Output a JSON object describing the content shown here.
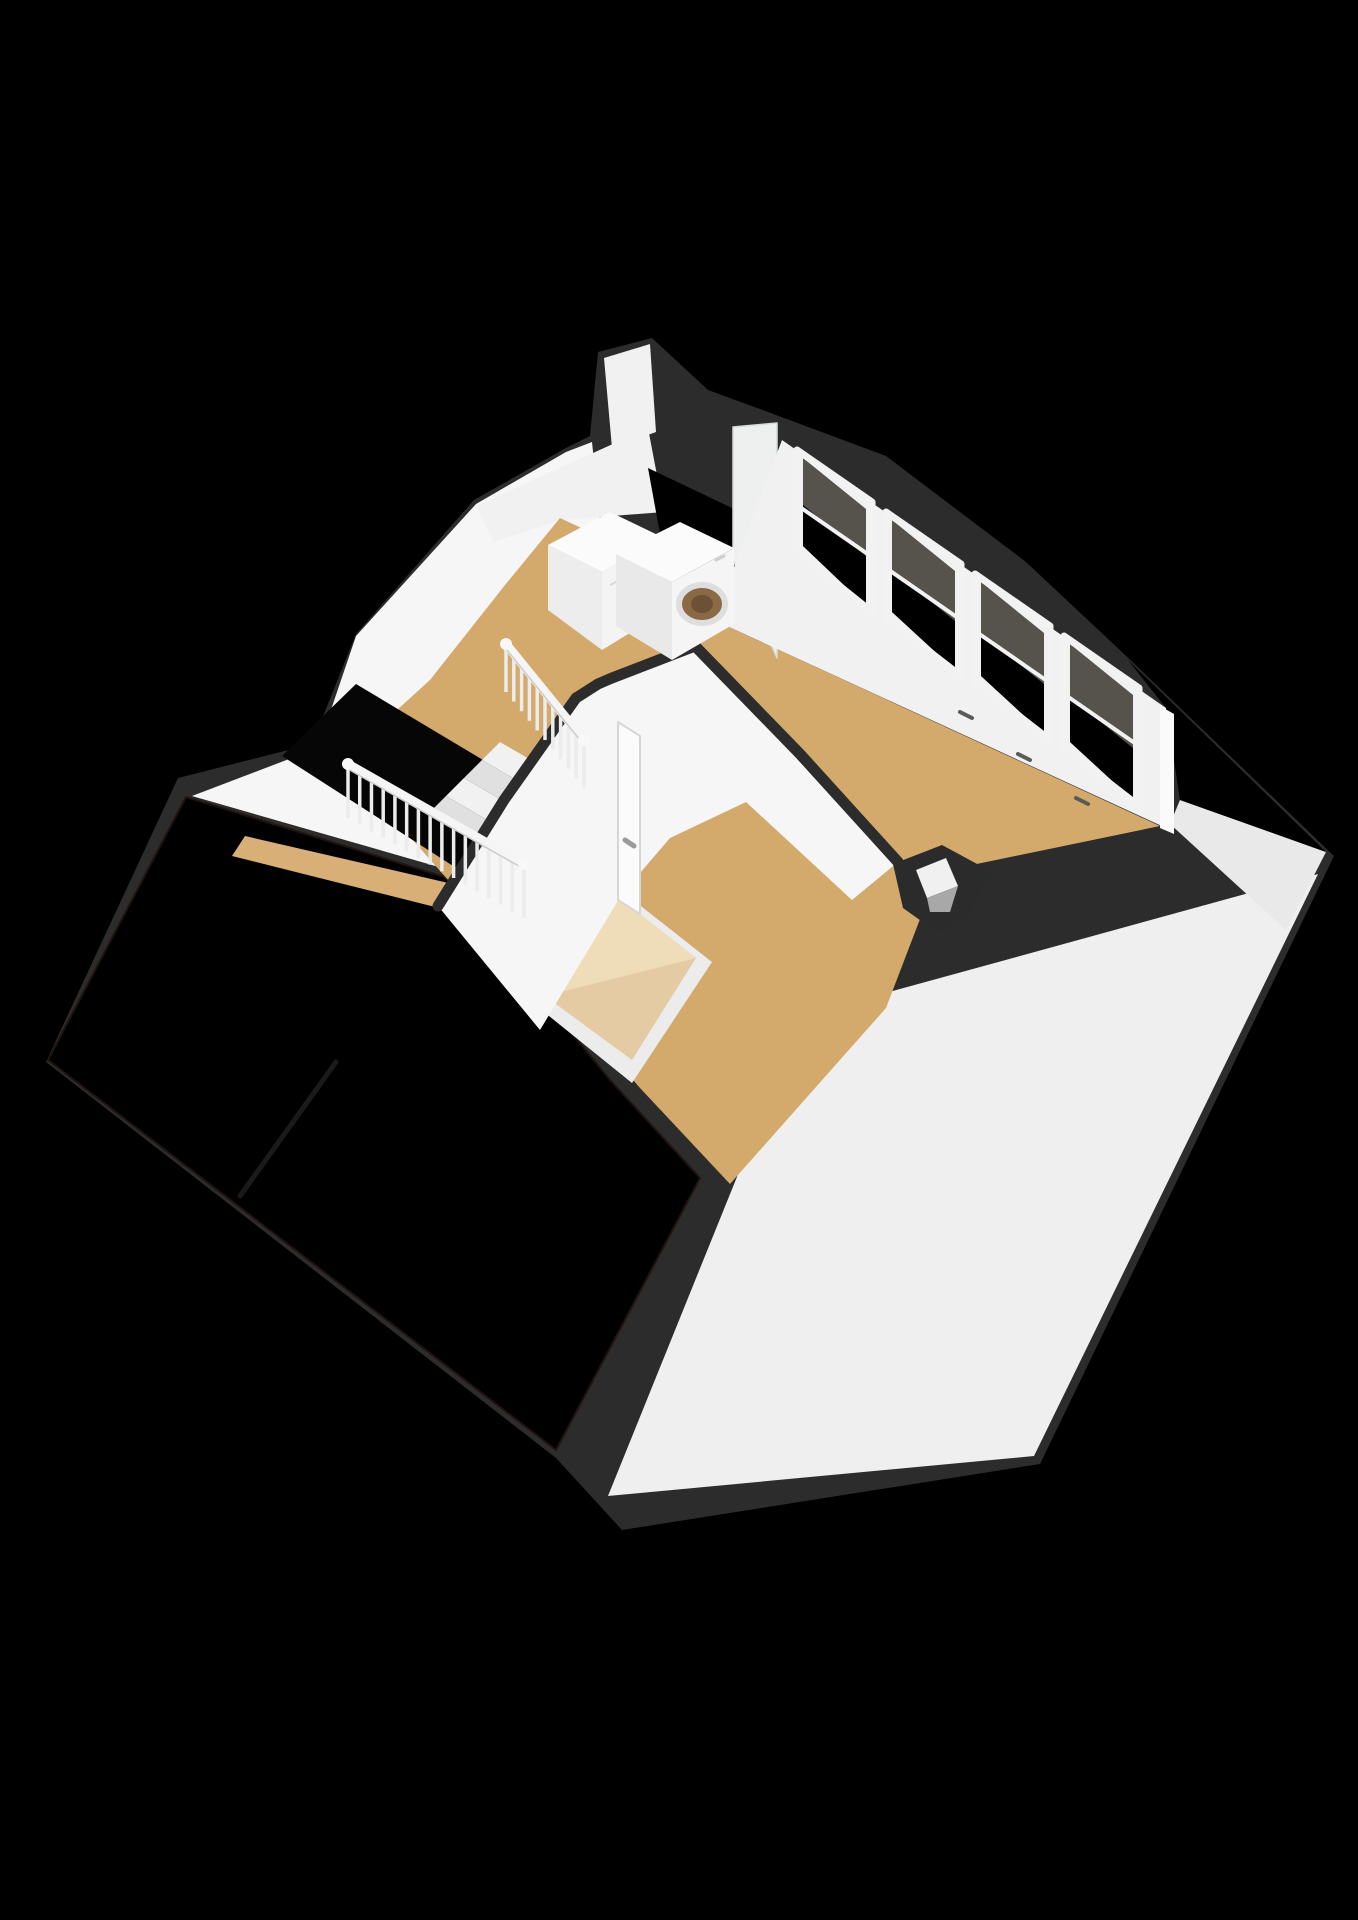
{
  "meta": {
    "kind": "3d-floorplan-render",
    "background": "#000000"
  },
  "palette": {
    "silhouette": "#2c2c2c",
    "roof_tile_base": "#6e4134",
    "roof_tile_shadow": "#59352a",
    "roof_tile_gap": "#231510",
    "pink_tile_base": "#c28266",
    "pink_tile_line": "#8e5442",
    "wall_bright": "#f6f6f6",
    "wall_plain": "#f1f1f1",
    "wall_dim": "#e9e9e9",
    "floor_tan": "#d3aa6c",
    "floor_tan_light": "#d8b077",
    "stairwell_black": "#060606",
    "step_light": "#f1f1f1",
    "step_dark": "#e0e0e0",
    "glass_dark": "#55534b",
    "frame_white": "#f2f2f2",
    "skylight_frame": "#ececec",
    "skylight_pane": "#e4cba3",
    "skylight_pane_hl": "#f0debb",
    "washer_glass": "#8a6a45",
    "washer_glass_inner": "#6e5034",
    "metal_grey": "#9a9a9a",
    "slope_white": "#efefef"
  },
  "scene": {
    "width": 1358,
    "height": 1920,
    "elements": [
      {
        "name": "house-silhouette-band",
        "kind": "polygon",
        "fill": "@silhouette",
        "points": "598,352 652,338 708,390 768,412 886,456 1026,562 1122,652 1334,856 1040,1464 622,1530 556,1458 46,1062 178,778 312,744 356,634 474,500 566,448 590,436"
      },
      {
        "name": "roof-slope-rear-white",
        "kind": "polygon",
        "fill": "@slope_white",
        "points": "802,1016 1318,874 1034,1456 608,1496"
      },
      {
        "name": "gable-wall-right-tip",
        "kind": "polygon",
        "fill": "@wall_dim",
        "points": "1180,800 1326,852 1286,930 1170,824"
      },
      {
        "name": "dormer-roof-right-tiles",
        "kind": "polygon",
        "fill": "#pinkTiles",
        "points": "1128,660 1326,852 1180,800 1166,708"
      },
      {
        "name": "gable-wall-left",
        "kind": "polygon",
        "fill": "@wall_bright",
        "points": "318,748 356,636 476,504 566,452 592,442 600,520 618,548 652,576 470,876 192,796"
      },
      {
        "name": "knee-wall-laundry",
        "kind": "polygon",
        "fill": "@wall_plain",
        "points": "476,506 648,428 664,512 560,520 494,542"
      },
      {
        "name": "dormer-back-wall",
        "kind": "polygon",
        "fill": "@wall_plain",
        "points": "604,358 650,344 656,432 612,448"
      },
      {
        "name": "dormer-roof-laundry-tiles",
        "kind": "polygon",
        "fill": "#pinkTiles",
        "points": "648,468 732,508 750,612 664,556"
      },
      {
        "name": "roof-front-tiled",
        "kind": "polygon",
        "fill": "#brownTiles",
        "stroke": "#201310",
        "strokeWidth": 2,
        "points": "186,797 448,878 500,945 610,1080 700,1178 556,1450 48,1060"
      },
      {
        "name": "roof-party-line",
        "kind": "path",
        "d": "M336,1062 L240,1196",
        "stroke": "#1a1a1a",
        "strokeWidth": 5,
        "linecap": "round"
      },
      {
        "name": "hall-floor-strip",
        "kind": "polygon",
        "fill": "@floor_tan_light",
        "points": "245,836 470,888 455,912 232,856"
      },
      {
        "name": "attic-floor",
        "kind": "polygon",
        "fill": "@floor_tan",
        "points": "560,518 650,560 714,620 1160,826 938,872 886,1008 730,1184 640,1088 522,952 448,880 342,760 430,680 505,585"
      },
      {
        "name": "skylight-frame",
        "kind": "polygon",
        "fill": "@skylight_frame",
        "points": "605,878 712,962 632,1083 523,995"
      },
      {
        "name": "skylight-pane",
        "kind": "polygon",
        "fill": "@skylight_pane",
        "points": "612,892 696,958 632,1060 545,996"
      },
      {
        "name": "skylight-pane-highlight",
        "kind": "polygon",
        "fill": "@skylight_pane_hl",
        "opacity": 0.9,
        "points": "612,892 696,958 545,996"
      },
      {
        "name": "stairwell-opening",
        "kind": "polygon",
        "fill": "@stairwell_black",
        "points": "356,684 560,806 478,882 282,756"
      },
      {
        "name": "stair-step",
        "kind": "polygon",
        "fill": "@step_light",
        "points": "500,742 548,770 530,788 482,760"
      },
      {
        "name": "stair-step",
        "kind": "polygon",
        "fill": "@step_dark",
        "points": "482,760 530,788 512,806 464,778"
      },
      {
        "name": "stair-step",
        "kind": "polygon",
        "fill": "@step_light",
        "points": "464,778 512,806 494,824 446,796"
      },
      {
        "name": "stair-step",
        "kind": "polygon",
        "fill": "@step_dark",
        "points": "446,796 494,824 476,842 428,814"
      },
      {
        "name": "hall-partition-wall",
        "kind": "polygon",
        "fill": "@wall_bright",
        "points": "438,906 504,800 576,698 612,678 695,646 800,754 898,862 852,900 746,802 670,838 622,894 540,1030"
      },
      {
        "name": "hall-partition-wall-cap",
        "kind": "path",
        "d": "M438,906 L504,800 L576,698 L598,684 L612,678 L695,646 L800,754 L898,862",
        "stroke": "@silhouette",
        "strokeWidth": 11,
        "linecap": "round"
      },
      {
        "name": "door-panel",
        "kind": "polygon",
        "fill": "#fbfbfb",
        "stroke": "#d6d6d6",
        "strokeWidth": 2,
        "points": "618,722 640,736 640,914 618,900"
      },
      {
        "name": "door-handle",
        "kind": "path",
        "d": "M625,840 L634,846",
        "stroke": "@metal_grey",
        "strokeWidth": 5,
        "linecap": "round"
      },
      {
        "name": "dormer-cheek-wall",
        "kind": "polygon",
        "fill": "#eef0f0",
        "stroke": "#d9d9d9",
        "strokeWidth": 1.5,
        "points": "733,427 777,423 777,658 733,560"
      },
      {
        "name": "window-wall",
        "kind": "polygon",
        "fill": "@wall_plain",
        "points": "782,440 1166,708 1166,828 714,620"
      },
      {
        "name": "window-wall-end-cap",
        "kind": "polygon",
        "fill": "#fafafa",
        "points": "1160,706 1174,714 1174,834 1160,828"
      },
      {
        "name": "window-glass",
        "kind": "polygon",
        "fill": "@glass_dark",
        "points": "803,458 866,509 866,606 803,546"
      },
      {
        "name": "window-glass-roof-view",
        "kind": "polygon",
        "fill": "#pinkTiles",
        "points": "803,505 866,556 866,606 803,546"
      },
      {
        "name": "window-frame",
        "kind": "polygon",
        "fill": "none",
        "stroke": "@frame_white",
        "strokeWidth": 7,
        "points": "797,450 872,502 872,612 797,552"
      },
      {
        "name": "window-mid-rail",
        "kind": "path",
        "d": "M797,505 L872,557",
        "stroke": "@frame_white",
        "strokeWidth": 4
      },
      {
        "name": "window-glass",
        "kind": "polygon",
        "fill": "@glass_dark",
        "points": "892,520 955,571 955,670 892,612"
      },
      {
        "name": "window-glass-roof-view",
        "kind": "polygon",
        "fill": "#pinkTiles",
        "points": "892,570 955,621 955,670 892,612"
      },
      {
        "name": "window-frame",
        "kind": "polygon",
        "fill": "none",
        "stroke": "@frame_white",
        "strokeWidth": 7,
        "points": "886,512 961,564 961,676 886,618"
      },
      {
        "name": "window-mid-rail",
        "kind": "path",
        "d": "M886,568 L961,620",
        "stroke": "@frame_white",
        "strokeWidth": 4
      },
      {
        "name": "window-glass",
        "kind": "polygon",
        "fill": "@glass_dark",
        "points": "981,582 1044,633 1044,734 981,676"
      },
      {
        "name": "window-glass-roof-view",
        "kind": "polygon",
        "fill": "#pinkTiles",
        "points": "981,633 1044,684 1044,734 981,676"
      },
      {
        "name": "window-frame",
        "kind": "polygon",
        "fill": "none",
        "stroke": "@frame_white",
        "strokeWidth": 7,
        "points": "975,574 1050,626 1050,740 975,682"
      },
      {
        "name": "window-mid-rail",
        "kind": "path",
        "d": "M975,631 L1050,683",
        "stroke": "@frame_white",
        "strokeWidth": 4
      },
      {
        "name": "window-glass",
        "kind": "polygon",
        "fill": "@glass_dark",
        "points": "1070,644 1133,695 1133,800 1070,742"
      },
      {
        "name": "window-glass-roof-view",
        "kind": "polygon",
        "fill": "#pinkTiles",
        "points": "1070,697 1133,748 1133,800 1070,742"
      },
      {
        "name": "window-frame",
        "kind": "polygon",
        "fill": "none",
        "stroke": "@frame_white",
        "strokeWidth": 7,
        "points": "1064,636 1139,688 1139,806 1064,748"
      },
      {
        "name": "window-mid-rail",
        "kind": "path",
        "d": "M1064,694 L1139,746",
        "stroke": "@frame_white",
        "strokeWidth": 4
      },
      {
        "name": "window-handle",
        "kind": "path",
        "d": "M960,712 L972,718",
        "stroke": "#5a5a5a",
        "strokeWidth": 4,
        "linecap": "round"
      },
      {
        "name": "window-handle",
        "kind": "path",
        "d": "M1018,754 L1030,760",
        "stroke": "#5a5a5a",
        "strokeWidth": 4,
        "linecap": "round"
      },
      {
        "name": "window-handle",
        "kind": "path",
        "d": "M1076,798 L1088,804",
        "stroke": "#5a5a5a",
        "strokeWidth": 4,
        "linecap": "round"
      },
      {
        "name": "dryer-top",
        "kind": "polygon",
        "fill": "#fbfbfb",
        "points": "548,545 610,512 664,538 602,572"
      },
      {
        "name": "dryer-side",
        "kind": "polygon",
        "fill": "#ededed",
        "points": "548,545 602,572 602,650 548,610"
      },
      {
        "name": "dryer-front",
        "kind": "polygon",
        "fill": "#f4f4f4",
        "points": "602,572 664,538 664,612 602,650"
      },
      {
        "name": "dryer-detail-line",
        "kind": "path",
        "d": "M610,585 L656,562",
        "stroke": "#d8d8d8",
        "strokeWidth": 2
      },
      {
        "name": "washer-top",
        "kind": "polygon",
        "fill": "#fbfbfb",
        "points": "616,554 680,522 734,548 672,582"
      },
      {
        "name": "washer-side",
        "kind": "polygon",
        "fill": "#e9e9e9",
        "points": "616,554 672,582 672,660 616,626"
      },
      {
        "name": "washer-front",
        "kind": "polygon",
        "fill": "#f5f5f5",
        "points": "672,582 734,548 734,624 672,660"
      },
      {
        "name": "washer-door",
        "kind": "ellipse",
        "cx": 702,
        "cy": 604,
        "rx": 23,
        "ry": 19,
        "fill": "@washer_glass",
        "stroke": "#dedede",
        "strokeWidth": 6
      },
      {
        "name": "washer-door-glass",
        "kind": "ellipse",
        "cx": 702,
        "cy": 604,
        "rx": 11,
        "ry": 9,
        "fill": "@washer_glass_inner"
      },
      {
        "name": "washer-dial",
        "kind": "path",
        "d": "M716,560 L724,556",
        "stroke": "#cfcfcf",
        "strokeWidth": 3,
        "linecap": "round"
      },
      {
        "name": "stair-railing-upper",
        "kind": "railing",
        "x1": 506,
        "y1": 644,
        "x2": 584,
        "y2": 740,
        "count": 11,
        "drop": 48
      },
      {
        "name": "stair-railing-lower",
        "kind": "railing",
        "x1": 348,
        "y1": 764,
        "x2": 524,
        "y2": 864,
        "count": 16,
        "drop": 54
      },
      {
        "name": "chimney-body",
        "kind": "polygon",
        "fill": "#2b2b2b",
        "points": "893,864 942,845 992,872 968,915 938,933 903,908"
      },
      {
        "name": "chimney-flue-light",
        "kind": "polygon",
        "fill": "#f0f0f0",
        "points": "916,870 946,858 958,886 927,898"
      },
      {
        "name": "chimney-flue-shadow",
        "kind": "polygon",
        "fill": "#a8a8a8",
        "points": "927,898 958,886 950,912 930,912"
      }
    ]
  }
}
